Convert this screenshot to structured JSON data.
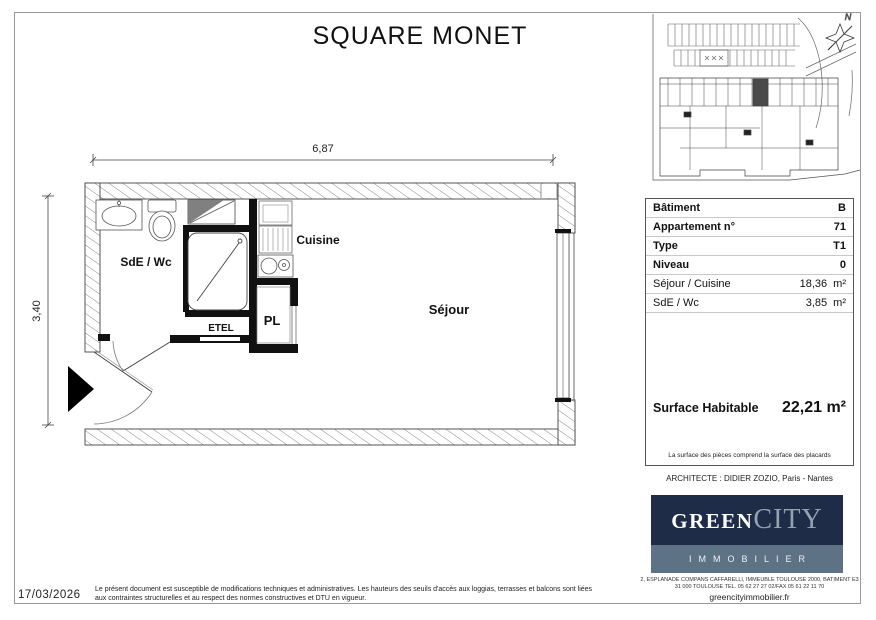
{
  "title": "SQUARE MONET",
  "site_plan": {
    "north_label": "N"
  },
  "floor_plan": {
    "dim_width": "6,87",
    "dim_height": "3,40",
    "rooms": {
      "bathroom": "SdE / Wc",
      "kitchen": "Cuisine",
      "closet": "PL",
      "etel": "ETEL",
      "living": "Séjour"
    }
  },
  "info_panel": {
    "rows": [
      {
        "label": "Bâtiment",
        "value": "B"
      },
      {
        "label": "Appartement n°",
        "value": "71"
      },
      {
        "label": "Type",
        "value": "T1"
      },
      {
        "label": "Niveau",
        "value": "0"
      }
    ],
    "areas": [
      {
        "label": "Séjour / Cuisine",
        "value": "18,36",
        "unit": "m²"
      },
      {
        "label": "SdE / Wc",
        "value": "3,85",
        "unit": "m²"
      }
    ],
    "surface": {
      "label": "Surface Habitable",
      "value": "22,21 m²"
    },
    "note": "La surface des pièces comprend la surface des placards"
  },
  "architect": "ARCHITECTE : DIDIER ZOZIO, Paris - Nantes",
  "brand": {
    "green": "GREEN",
    "city": "CITY",
    "subtitle": "IMMOBILIER",
    "address_line1": "2, ESPLANADE COMPANS CAFFARELLI, IMMEUBLE TOULOUSE 2000, BATIMENT E3",
    "address_line2": "31 000 TOULOUSE TEL. 05 62 27 27 02/FAX 05 61 22 11 70",
    "website": "greencityimmobilier.fr",
    "navy": "#1e2c48",
    "slate": "#5d7285",
    "city_color": "#94a2b0"
  },
  "footer": {
    "date": "17/03/2026",
    "legal_line1": "Le présent document est susceptible de modifications techniques et administratives. Les hauteurs des seuils d'accès aux loggias, terrasses et balcons sont liées",
    "legal_line2": "aux contraintes structurelles et au respect des normes constructives et DTU en vigueur."
  }
}
